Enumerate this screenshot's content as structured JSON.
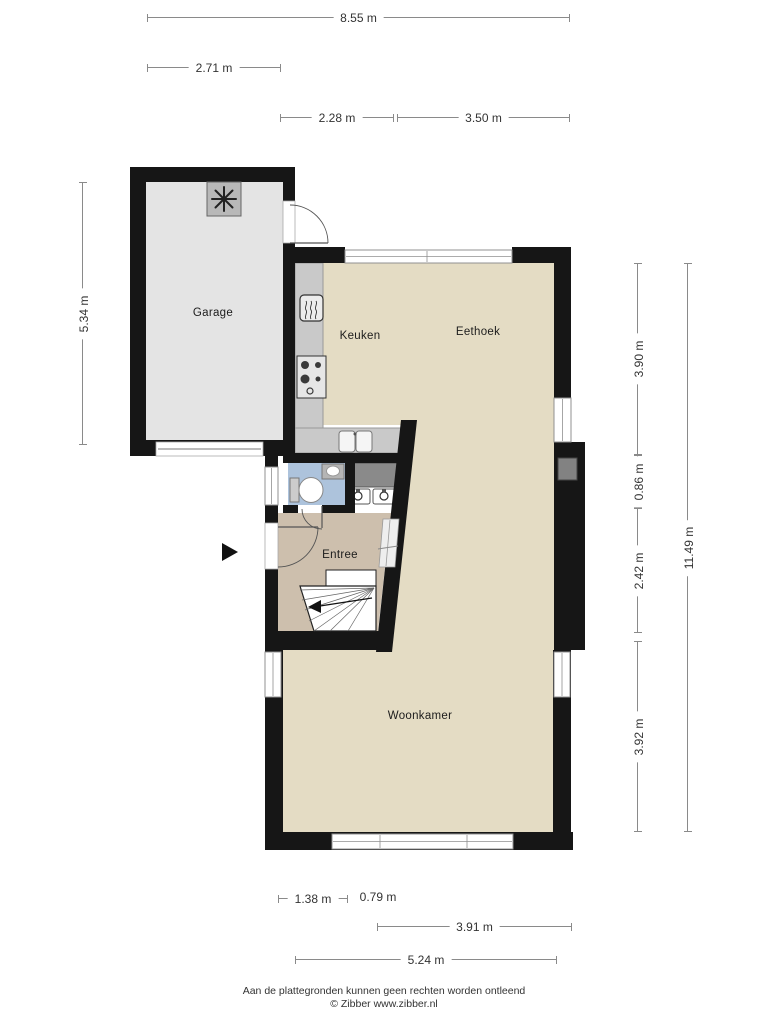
{
  "rooms": {
    "garage": "Garage",
    "keuken": "Keuken",
    "eethoek": "Eethoek",
    "entree": "Entree",
    "woonkamer": "Woonkamer"
  },
  "dims": {
    "w855": "8.55 m",
    "w271": "2.71 m",
    "w228": "2.28 m",
    "w350": "3.50 m",
    "h534": "5.34 m",
    "h390": "3.90 m",
    "h086": "0.86 m",
    "h242": "2.42 m",
    "h392": "3.92 m",
    "h1149": "11.49 m",
    "w138": "1.38 m",
    "w079": "0.79 m",
    "w391": "3.91 m",
    "w524": "5.24 m"
  },
  "footer": {
    "line1": "Aan de plattegronden kunnen geen rechten worden ontleend",
    "line2": "© Zibber www.zibber.nl"
  },
  "colors": {
    "wall": "#161616",
    "floor_main": "#e4dcc4",
    "floor_garage": "#e4e4e4",
    "floor_entree": "#cdbfad",
    "floor_toilet": "#adc3dc",
    "counter": "#c9c9c9",
    "counter_dark": "#8a8a8a",
    "window_frame": "#909090",
    "door_arc": "#555555",
    "dim_line": "#8a8a8a",
    "text": "#333333"
  },
  "icons": {
    "heater": "eight-spoke-asterisk",
    "boiler": "wavy-lines-unit",
    "stove": "four-burner-hob",
    "sink": "double-bowl-sink",
    "toilet": "toilet-top-view",
    "washbasins": "two-basins-with-taps",
    "entrance": "right-pointing-arrow",
    "stairs": "winder-stair-with-arrow"
  }
}
